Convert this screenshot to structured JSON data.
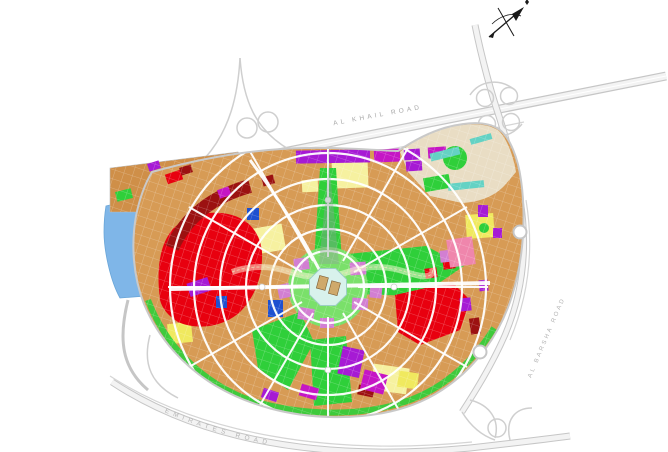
{
  "map": {
    "road_labels": {
      "top": "AL KHAIL ROAD",
      "right": "AL BARSHA ROAD",
      "bottom": "EMIRATES ROAD"
    },
    "icons": {
      "north_arrow": "compass-north-arrow-icon"
    },
    "palette": {
      "parcel_tan": "#d79b55",
      "parcel_dark_tan": "#cf8f48",
      "beige": "#e9ddc4",
      "red": "#e8000f",
      "dark_red": "#9c1111",
      "yellow": "#f6f1a0",
      "bright_yellow": "#f0e95f",
      "green": "#2fcf3a",
      "light_green": "#7ae06a",
      "teal": "#64d2c4",
      "plaza": "#d8f2ec",
      "purple": "#a61ad4",
      "magenta": "#c516c5",
      "violet": "#d27fd2",
      "pink": "#ef86ac",
      "blue": "#1e50d0",
      "lake": "#7fb6e8",
      "building": "#cfa96b"
    }
  }
}
